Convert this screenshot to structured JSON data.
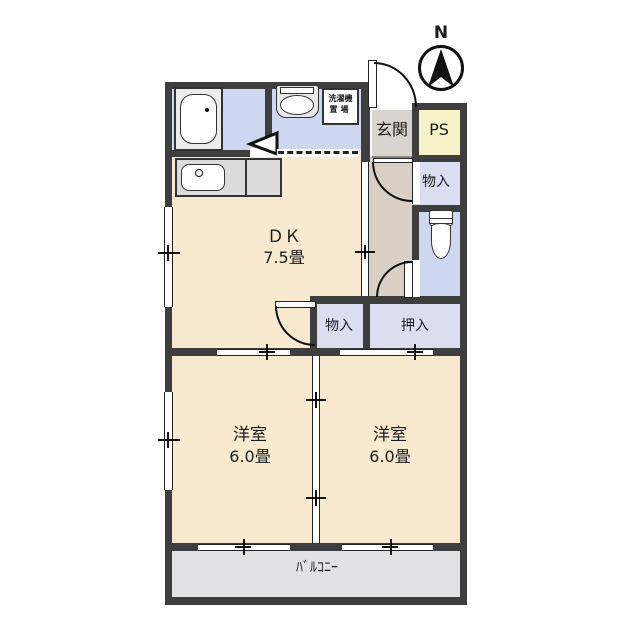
{
  "compass": {
    "label": "N"
  },
  "labels": {
    "genkan": "玄関",
    "ps": "PS",
    "storage_upper": "物入",
    "storage_mid": "物入",
    "oshiire": "押入",
    "dk_name": "ＤＫ",
    "dk_size": "7.5畳",
    "bedroom_left_name": "洋室",
    "bedroom_left_size": "6.0畳",
    "bedroom_right_name": "洋室",
    "bedroom_right_size": "6.0畳",
    "balcony": "ﾊﾞﾙｺﾆｰ",
    "laundry_line1": "洗濯機",
    "laundry_line2": "置場"
  },
  "colors": {
    "wall": "#3e3e3e",
    "room_beige": "#f8e9d0",
    "wet_area_blue": "#cdd7f0",
    "closet_lavender": "#dcddf1",
    "ps_yellow": "#f8f2c8",
    "genkan_gray": "#d8d4cf",
    "hallway_tan": "#d9cfc5",
    "balcony_gray": "#e2e2e5",
    "counter_gray": "#dcdcdc"
  }
}
